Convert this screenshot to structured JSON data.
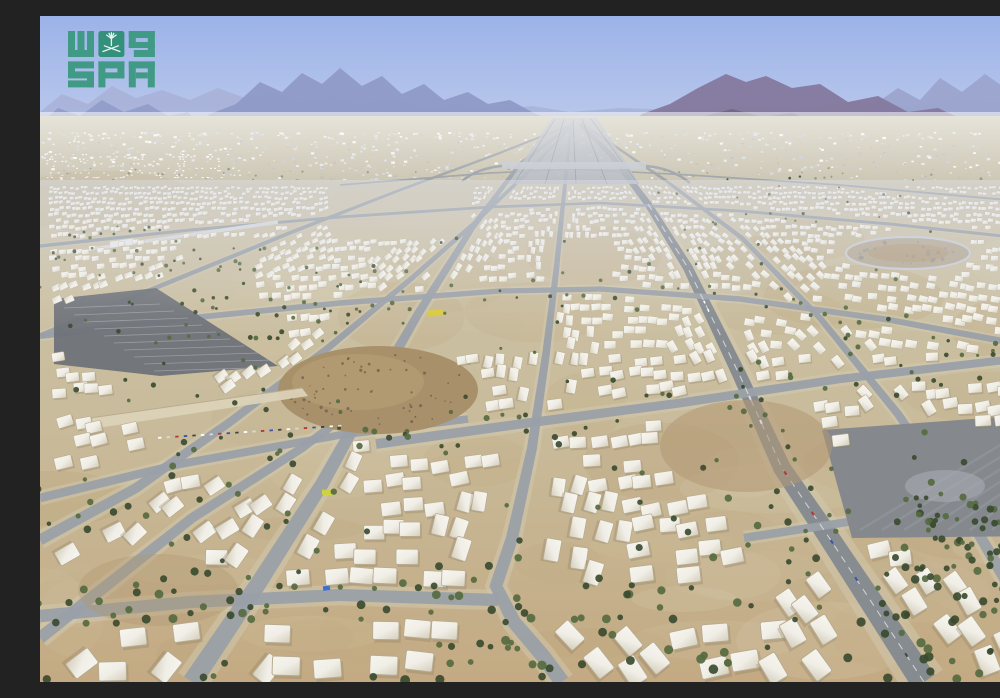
{
  "photo": {
    "type": "aerial-photograph",
    "description": "Aerial view of the Mina tent city near Makkah: thousands of white pilgrim tents arranged in blocks, a road network radiating toward a hazy horizon, scattered dark green trees, parking lots, and barren rocky mountains under a hazy light-blue sky.",
    "width_px": 1000,
    "height_px": 666
  },
  "watermark": {
    "agency_latin": "SPA",
    "agency_arabic": "واس",
    "description": "Saudi Press Agency (SPA) watermark logo with palm tree and crossed swords emblem",
    "emblem": "palm-tree-and-crossed-swords"
  },
  "colors": {
    "sky_top": "#9cb3e9",
    "sky_mid": "#b6c5ea",
    "sky_horizon": "#dde3f0",
    "mtn_far": "#a9b3d9",
    "mtn_mid": "#8f9ac7",
    "mtn_right_back": "#9aa3cc",
    "mtn_right": "#857a9e",
    "mtn_right_front": "#6e6482",
    "hill_brown": "#a8906a",
    "hill_speckle": "#6a5844",
    "plain": "#cbc5b2",
    "sand_top": "#cdc4ab",
    "sand_mid": "#c9bc9c",
    "sand_bottom": "#c3aa83",
    "dirt": "#b29872",
    "shoulder": "#d2c9b0",
    "tent": "#f6f5ef",
    "tent_mid": "#f0eee6",
    "tent_shade": "#d8d2c2",
    "tent_edge": "#b7ab90",
    "tent_shadow": "#8a7a5e",
    "road": "#9aa0a7",
    "road_major": "#83898f",
    "road_light": "#b6bbc3",
    "lane": "#eceef2",
    "tree_dark": "#3b4b30",
    "tree_mid": "#566a40",
    "asphalt_left": "#6e7278",
    "asphalt_right": "#85898e",
    "asphalt_streak": "#a7adb6",
    "ring_fill": "#b6ab95",
    "ring_stroke": "#c9ccd3",
    "rail": "#d9dbe0",
    "ramp_wall": "#dbd2b8",
    "yellow_building": "#d8ca3a",
    "yellow_building2": "#cdd23e",
    "tarp_blue": "#3a6fd8",
    "car_red": "#b23a36",
    "car_blue": "#3a55b0",
    "logo_green": "#39987e",
    "logo_green_dark": "#2b8e73",
    "emblem_white": "#f2f7f4",
    "haze_white": "#ffffff",
    "haze_blue": "#aebade"
  },
  "scene": {
    "sky": "hazy light blue with no clouds",
    "approx_tent_count": 2600,
    "approx_tree_count": 480,
    "distant_speck_count": 900,
    "landmarks": [
      "highway corridor converging at horizon vanishing point",
      "oval ring road on right mid-ground",
      "dark parking lot left mid-ground",
      "large paved lot lower right",
      "rocky brown hill with embankment wall left-center",
      "elevated rail line upper left",
      "row of parked cars on left",
      "small yellow building center",
      "blue tarp lower left"
    ]
  }
}
